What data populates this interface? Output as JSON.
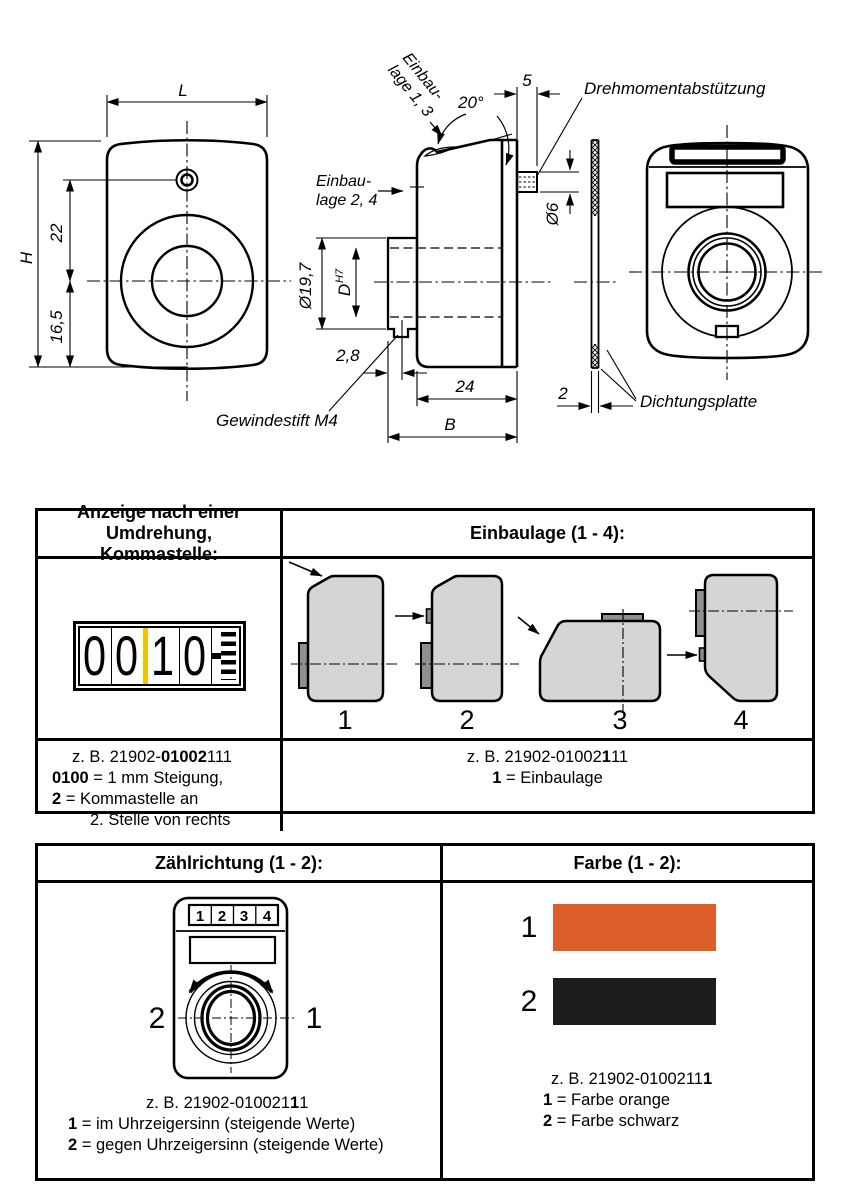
{
  "drawing": {
    "front_view": {
      "dim_length": "L",
      "dim_height": "H",
      "dim_22": "22",
      "dim_16_5": "16,5"
    },
    "side_view": {
      "einbaulage_13_line1": "Einbau-",
      "einbaulage_13_line2": "lage 1, 3",
      "angle": "20°",
      "dim_5": "5",
      "einbaulage_24_line1": "Einbau-",
      "einbaulage_24_line2": "lage 2, 4",
      "dia_collar": "Ø19,7",
      "bore_dim": "D",
      "bore_tolerance": "H7",
      "dim_2_8": "2,8",
      "dim_24": "24",
      "dim_width": "B",
      "set_screw_label": "Gewindestift M4",
      "dia_pin": "Ø6"
    },
    "seal_view": {
      "torque_support_label": "Drehmomentabstützung",
      "dim_2": "2",
      "seal_plate_label": "Dichtungsplatte"
    }
  },
  "table1": {
    "header_left": "Anzeige nach einer Umdrehung, Kommastelle:",
    "header_right": "Einbaulage (1 - 4):",
    "counter_digits": [
      "0",
      "0",
      "1",
      "0"
    ],
    "position_labels": [
      "1",
      "2",
      "3",
      "4"
    ],
    "caption_left": {
      "l1a": "z. B. 21902-",
      "l1b": "01002",
      "l1c": "111",
      "l2a": "0100",
      "l2b": " = 1 mm Steigung,",
      "l3a": "2",
      "l3b": " = Kommastelle an",
      "l4": "2. Stelle von rechts"
    },
    "caption_right": {
      "l1a": "z. B. 21902-01002",
      "l1b": "1",
      "l1c": "11",
      "l2a": "1",
      "l2b": " = Einbaulage"
    }
  },
  "table2": {
    "header_left": "Zählrichtung (1 - 2):",
    "header_right": "Farbe (1 - 2):",
    "device_digits": [
      "1",
      "2",
      "3",
      "4"
    ],
    "direction_label_ccw": "2",
    "direction_label_cw": "1",
    "swatches": [
      {
        "label": "1",
        "name": "Farbe orange",
        "color": "#DC5E28"
      },
      {
        "label": "2",
        "name": "Farbe schwarz",
        "color": "#1D1D1B"
      }
    ],
    "caption_left": {
      "l1a": "z. B. 21902-010021",
      "l1b": "1",
      "l1c": "1",
      "l2a": "1",
      "l2b": " = im Uhrzeigersinn (steigende Werte)",
      "l3a": "2",
      "l3b": " = gegen Uhrzeigersinn (steigende Werte)"
    },
    "caption_right": {
      "l1a": "z. B. 21902-0100211",
      "l1b": "1",
      "l2a": "1",
      "l2b": " = Farbe orange",
      "l3a": "2",
      "l3b": " = Farbe schwarz"
    }
  },
  "colors": {
    "counter_divider": "#F5C400",
    "swatch_orange": "#DC5E28",
    "swatch_black": "#1D1D1B",
    "shape_fill": "#D5D5D5",
    "tab_fill": "#8F8F8F"
  }
}
